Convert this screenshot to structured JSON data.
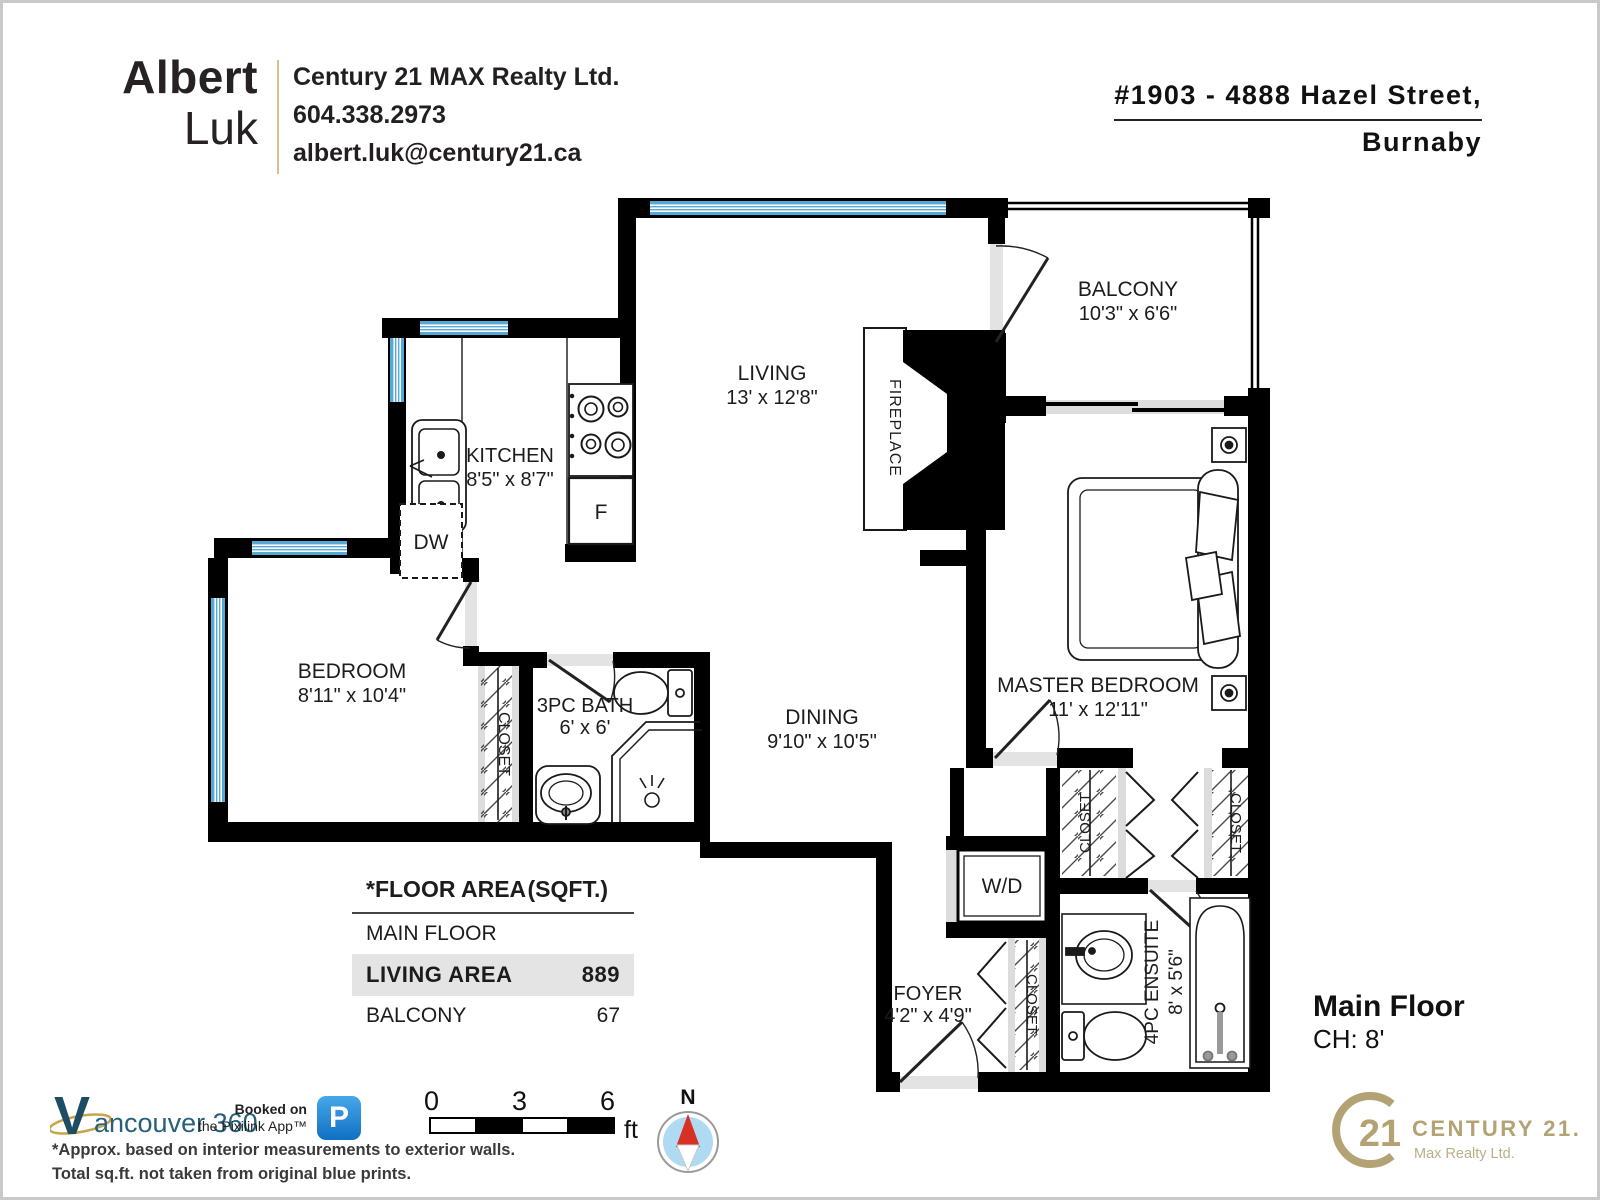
{
  "header": {
    "agent": {
      "first": "Albert",
      "last": "Luk"
    },
    "brokerage": "Century 21 MAX Realty Ltd.",
    "phone": "604.338.2973",
    "email": "albert.luk@century21.ca",
    "address_line1": "#1903 - 4888 Hazel Street,",
    "address_line2": "Burnaby"
  },
  "rooms": {
    "living": {
      "name": "LIVING",
      "dims": "13' x 12'8\""
    },
    "kitchen": {
      "name": "KITCHEN",
      "dims": "8'5\" x 8'7\""
    },
    "balcony": {
      "name": "BALCONY",
      "dims": "10'3\" x 6'6\""
    },
    "master": {
      "name": "MASTER BEDROOM",
      "dims": "11' x 12'11\""
    },
    "bedroom": {
      "name": "BEDROOM",
      "dims": "8'11\" x 10'4\""
    },
    "bath": {
      "name": "3PC BATH",
      "dims": "6' x 6'"
    },
    "dining": {
      "name": "DINING",
      "dims": "9'10\" x 10'5\""
    },
    "foyer": {
      "name": "FOYER",
      "dims": "4'2\" x 4'9\""
    },
    "ensuite": {
      "name": "4PC ENSUITE",
      "dims": "8' x 5'6\""
    }
  },
  "labels": {
    "closet": "CLOSET",
    "fireplace": "FIREPLACE",
    "washer_dryer": "W/D",
    "dishwasher": "DW",
    "fridge": "F"
  },
  "area_table": {
    "title": "*FLOOR AREA",
    "unit_header": "(SQFT.)",
    "rows": [
      {
        "label": "MAIN FLOOR",
        "value": ""
      },
      {
        "label": "LIVING AREA",
        "value": "889"
      },
      {
        "label": "BALCONY",
        "value": "67"
      }
    ]
  },
  "plan_info": {
    "floor_label": "Main Floor",
    "ceiling_height": "CH: 8'"
  },
  "scale_bar": {
    "tick0": "0",
    "tick3": "3",
    "tick6": "6",
    "unit": "ft"
  },
  "compass": {
    "north": "N"
  },
  "footer": {
    "vancouver360": {
      "v": "V",
      "rest": "ancouver 360"
    },
    "pixilink_line1": "Booked on",
    "pixilink_line2": "the Pixilink App™",
    "pixilink_icon_letter": "P",
    "disclaimer_line1": "*Approx. based on interior measurements to exterior walls.",
    "disclaimer_line2": "Total sq.ft. not taken from original blue prints.",
    "century21": {
      "circle_number": "21",
      "name": "CENTURY 21.",
      "sub": "Max Realty Ltd."
    }
  },
  "colors": {
    "wall": "#000000",
    "window_blue": "#55a9d6",
    "door_opening_gray": "#e3e3e3",
    "gold": "#b3a273",
    "teal": "#1d4d62",
    "pixilink_blue": "#1e83d3",
    "compass_blue": "#aedaf2",
    "compass_red": "#d93025"
  }
}
